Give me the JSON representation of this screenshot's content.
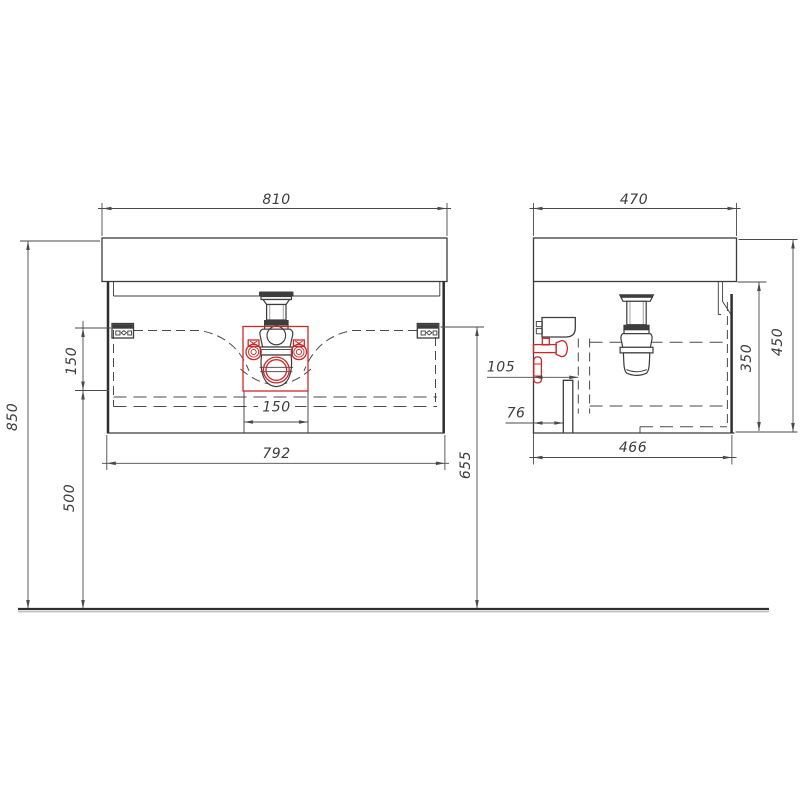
{
  "drawing_type": "furniture-technical-drawing",
  "colors": {
    "line": "#3c3c3c",
    "dim_line": "#4a4a4a",
    "highlight_red": "#cd2828",
    "background": "#ffffff"
  },
  "front_view": {
    "dimensions": {
      "basin_width": "810",
      "total_height": "850",
      "drain_zone_height": "150",
      "height_below_drain": "500",
      "cabinet_width": "792",
      "drain_zone_width": "150",
      "bracket_height": "655"
    }
  },
  "side_view": {
    "dimensions": {
      "basin_depth": "470",
      "cabinet_depth": "466",
      "overall_height": "450",
      "cabinet_height": "350",
      "drain_wall_offset": "105",
      "pipe_wall_offset": "76"
    }
  }
}
